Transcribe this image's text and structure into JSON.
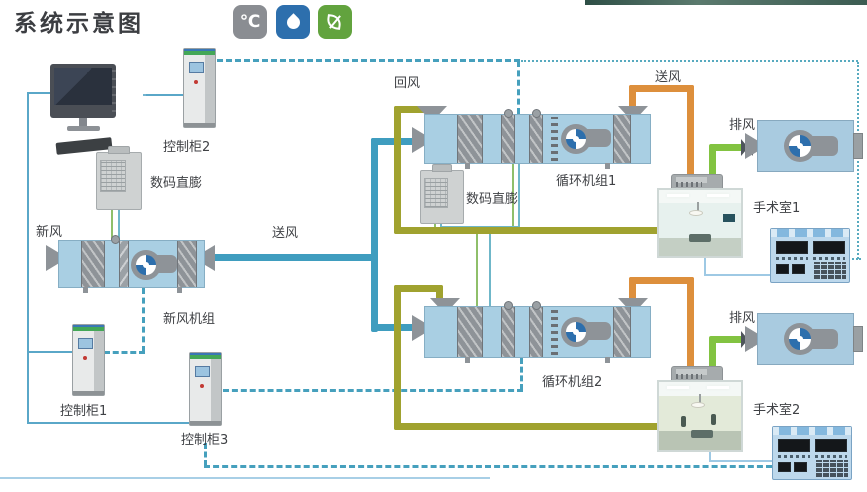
{
  "header": {
    "title": "系统示意图",
    "icons": [
      {
        "name": "temperature-icon",
        "glyph": "℃",
        "bg": "#8a8d92"
      },
      {
        "name": "humidity-icon",
        "glyph": "",
        "bg": "#2d6fad"
      },
      {
        "name": "eco-icon",
        "glyph": "",
        "bg": "#62a33e"
      }
    ]
  },
  "labels": {
    "control_cabinet_1": "控制柜1",
    "control_cabinet_2": "控制柜2",
    "control_cabinet_3": "控制柜3",
    "digital_dx_1": "数码直膨",
    "digital_dx_2": "数码直膨",
    "fresh_air": "新风",
    "supply_air_main": "送风",
    "supply_air_room1": "送风",
    "return_air": "回风",
    "fresh_air_unit": "新风机组",
    "circulation_unit_1": "循环机组1",
    "circulation_unit_2": "循环机组2",
    "exhaust_air_room1": "排风",
    "exhaust_air_room2": "排风",
    "operating_room_1": "手术室1",
    "operating_room_2": "手术室2"
  },
  "colors": {
    "supply_pipe_blue": "#3f9dbf",
    "return_pipe_olive": "#a0a22f",
    "supply_duct_orange": "#dd8f3c",
    "exhaust_pipe_green": "#82c341",
    "control_line_dashed": "#46a0bd",
    "ahu_body": "#a9cfe3"
  }
}
